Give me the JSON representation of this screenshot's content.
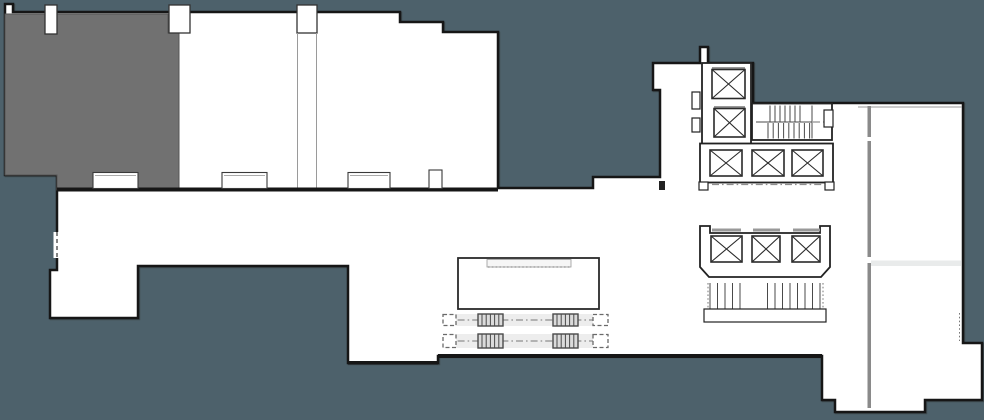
{
  "document": {
    "kind": "architectural floor plan drawing",
    "visible_text": [],
    "description": "Irregular white building floor plate on a dark slate background; gray highlighted room at upper left; elevator core with X-marked shafts; stairwell; two escalator runs; stage platform outline; right wing with gray wall line."
  },
  "colors": {
    "background": "#4D616B",
    "plan_fill": "#FFFFFF",
    "outline": "#161616",
    "interior_line": "#2A2A2A",
    "highlight_room": "#717171",
    "wall_gray": "#8A8A8A",
    "band_gray": "#E9EBEB",
    "strip_fill": "#EDEDED",
    "tread_fill": "#DBDBDB",
    "dash_gray": "#8F8F8F"
  },
  "features": {
    "highlighted_room_position": "upper-left",
    "elevator_shaft_count": 8,
    "escalator_run_count": 2,
    "stairwell_count": 1,
    "column_notch_count": 3,
    "wall_recess_count": 4
  }
}
